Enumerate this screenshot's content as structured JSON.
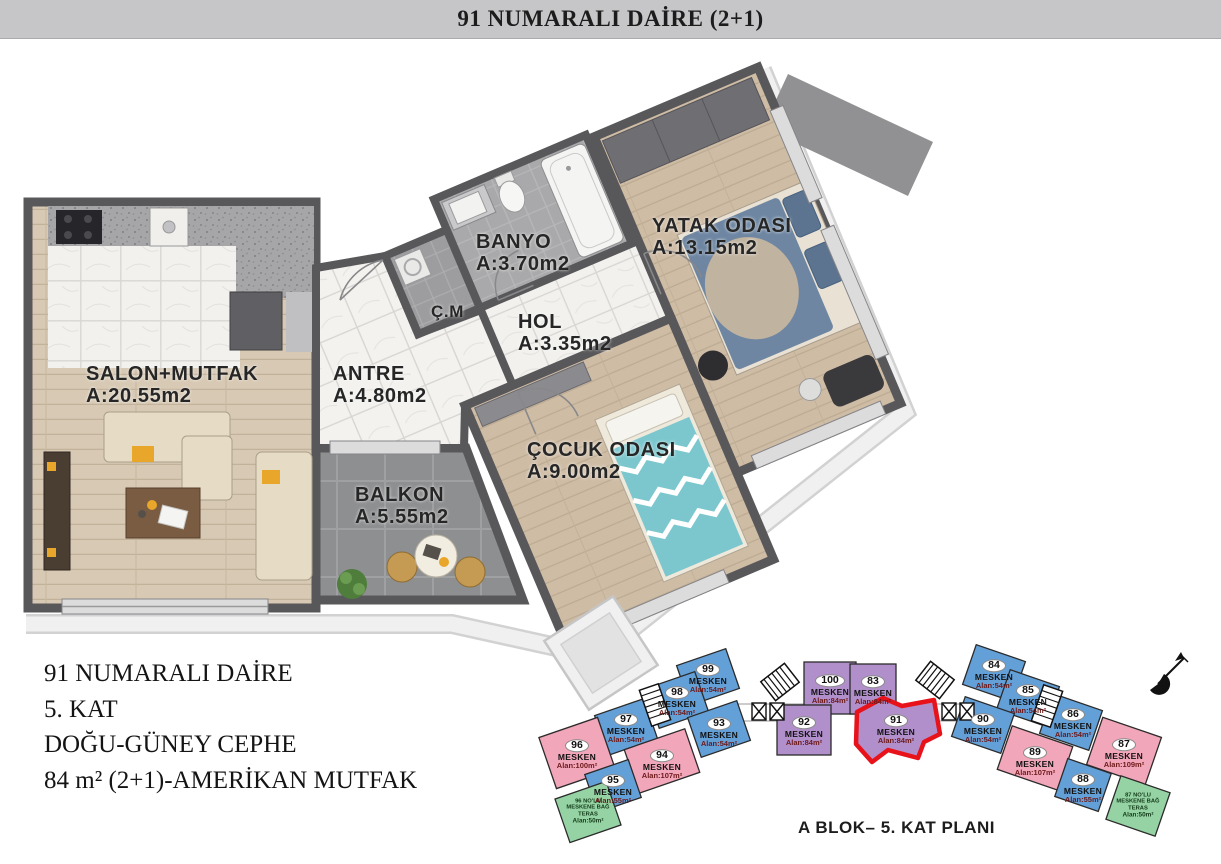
{
  "header": {
    "title": "91 NUMARALI DAİRE (2+1)"
  },
  "floor_plan": {
    "rooms": [
      {
        "id": "salon",
        "name": "SALON+MUTFAK",
        "area": "A:20.55m2"
      },
      {
        "id": "antre",
        "name": "ANTRE",
        "area": "A:4.80m2"
      },
      {
        "id": "banyo",
        "name": "BANYO",
        "area": "A:3.70m2"
      },
      {
        "id": "cm",
        "name": "Ç.M",
        "area": ""
      },
      {
        "id": "hol",
        "name": "HOL",
        "area": "A:3.35m2"
      },
      {
        "id": "yatak",
        "name": "YATAK ODASI",
        "area": "A:13.15m2"
      },
      {
        "id": "cocuk",
        "name": "ÇOCUK ODASI",
        "area": "A:9.00m2"
      },
      {
        "id": "balkon",
        "name": "BALKON",
        "area": "A:5.55m2"
      }
    ]
  },
  "info": {
    "line1": "91 NUMARALI DAİRE",
    "line2": "5. KAT",
    "line3": "DOĞU-GÜNEY CEPHE",
    "line4": "84 m² (2+1)-AMERİKAN MUTFAK"
  },
  "keyplan": {
    "caption": "A BLOK– 5. KAT PLANI",
    "highlight_unit": "91",
    "units": [
      {
        "no": "99",
        "label": "MESKEN",
        "area": "Alan:54m²",
        "color": "blue"
      },
      {
        "no": "98",
        "label": "MESKEN",
        "area": "Alan:54m²",
        "color": "blue"
      },
      {
        "no": "97",
        "label": "MESKEN",
        "area": "Alan:54m²",
        "color": "blue"
      },
      {
        "no": "93",
        "label": "MESKEN",
        "area": "Alan:54m²",
        "color": "blue"
      },
      {
        "no": "96",
        "label": "MESKEN",
        "area": "Alan:100m²",
        "color": "pink"
      },
      {
        "no": "94",
        "label": "MESKEN",
        "area": "Alan:107m²",
        "color": "pink"
      },
      {
        "no": "95",
        "label": "MESKEN",
        "area": "Alan:55m²",
        "color": "blue"
      },
      {
        "no": "100",
        "label": "MESKEN",
        "area": "Alan:84m²",
        "color": "purple"
      },
      {
        "no": "83",
        "label": "MESKEN",
        "area": "Alan:84m²",
        "color": "purple"
      },
      {
        "no": "92",
        "label": "MESKEN",
        "area": "Alan:84m²",
        "color": "purple"
      },
      {
        "no": "91",
        "label": "MESKEN",
        "area": "Alan:84m²",
        "color": "purple"
      },
      {
        "no": "84",
        "label": "MESKEN",
        "area": "Alan:54m²",
        "color": "blue"
      },
      {
        "no": "85",
        "label": "MESKEN",
        "area": "Alan:54m²",
        "color": "blue"
      },
      {
        "no": "86",
        "label": "MESKEN",
        "area": "Alan:54m²",
        "color": "blue"
      },
      {
        "no": "90",
        "label": "MESKEN",
        "area": "Alan:54m²",
        "color": "blue"
      },
      {
        "no": "89",
        "label": "MESKEN",
        "area": "Alan:107m²",
        "color": "pink"
      },
      {
        "no": "87",
        "label": "MESKEN",
        "area": "Alan:109m²",
        "color": "pink"
      },
      {
        "no": "88",
        "label": "MESKEN",
        "area": "Alan:55m²",
        "color": "blue"
      }
    ],
    "terraces": [
      {
        "lines": "96 NO'LU\nMESKENE BAĞ\nTERAS",
        "area": "Alan:50m²"
      },
      {
        "lines": "87 NO'LU\nMESKENE BAĞ\nTERAS",
        "area": "Alan:50m²"
      }
    ],
    "colors": {
      "blue": "#64a0d8",
      "pink": "#f2a6ba",
      "purple": "#b18fca",
      "green": "#96d3a4",
      "highlight": "#e8121a"
    }
  }
}
